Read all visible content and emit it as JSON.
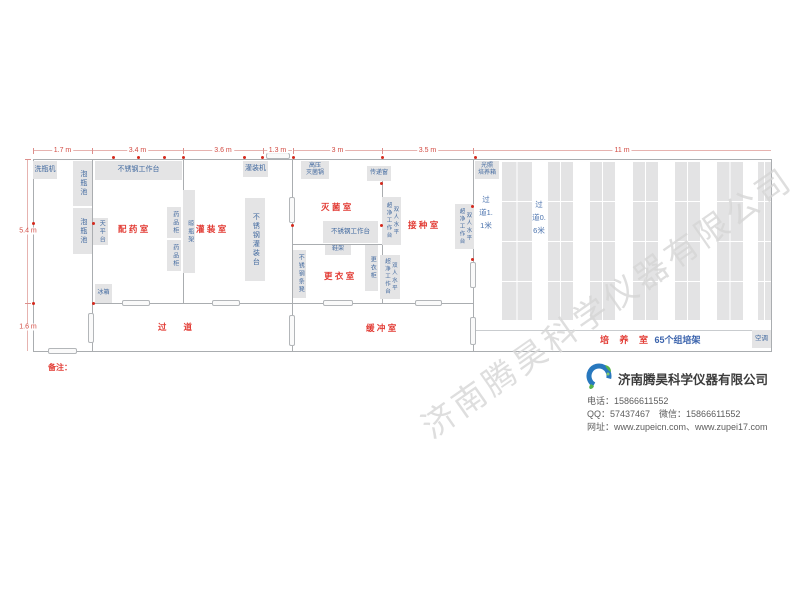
{
  "watermark": "济南腾昊科学仪器有限公司",
  "colors": {
    "equipment_fill": "#e4e4e5",
    "equipment_text_blue": "#41699f",
    "room_label_red": "#e23b34",
    "dimension_red": "#d24a42",
    "wall_gray": "#aaadb0",
    "socket_red": "#d42a1e",
    "logo_blue": "#2878be",
    "logo_green": "#56b44a"
  },
  "plan": {
    "walls": [
      {
        "x": 33,
        "y": 159,
        "w": 739,
        "h": 1
      },
      {
        "x": 33,
        "y": 351,
        "w": 739,
        "h": 1
      },
      {
        "x": 33,
        "y": 159,
        "w": 1,
        "h": 193
      },
      {
        "x": 771,
        "y": 159,
        "w": 1,
        "h": 193
      },
      {
        "x": 92,
        "y": 159,
        "w": 1,
        "h": 145
      },
      {
        "x": 92,
        "y": 303,
        "w": 1,
        "h": 49
      },
      {
        "x": 92,
        "y": 303,
        "w": 381,
        "h": 1
      },
      {
        "x": 183,
        "y": 159,
        "w": 1,
        "h": 145
      },
      {
        "x": 292,
        "y": 159,
        "w": 1,
        "h": 193
      },
      {
        "x": 382,
        "y": 166,
        "w": 1,
        "h": 138
      },
      {
        "x": 293,
        "y": 244,
        "w": 90,
        "h": 1
      },
      {
        "x": 473,
        "y": 159,
        "w": 1,
        "h": 193
      },
      {
        "x": 473,
        "y": 330,
        "w": 298,
        "h": 1,
        "lite": true
      }
    ],
    "equipment": [
      {
        "l": "洗瓶机",
        "x": 33,
        "y": 161,
        "w": 24,
        "h": 18,
        "o": "h",
        "fs": 7
      },
      {
        "l": "泡瓶池",
        "x": 73,
        "y": 161,
        "w": 19,
        "h": 45,
        "o": "v",
        "fs": 7
      },
      {
        "l": "泡瓶池",
        "x": 73,
        "y": 208,
        "w": 19,
        "h": 46,
        "o": "v",
        "fs": 7
      },
      {
        "l": "不锈钢工作台",
        "x": 95,
        "y": 161,
        "w": 87,
        "h": 19,
        "o": "h",
        "fs": 7
      },
      {
        "l": "灌装机",
        "x": 243,
        "y": 161,
        "w": 25,
        "h": 16,
        "o": "h",
        "fs": 7
      },
      {
        "l": "天平台",
        "x": 93,
        "y": 218,
        "w": 15,
        "h": 27,
        "o": "v",
        "fs": 6
      },
      {
        "l": "药品柜",
        "x": 167,
        "y": 207,
        "w": 14,
        "h": 31,
        "o": "v",
        "fs": 6
      },
      {
        "l": "药品柜",
        "x": 167,
        "y": 240,
        "w": 14,
        "h": 31,
        "o": "v",
        "fs": 6
      },
      {
        "l": "晾瓶架",
        "x": 183,
        "y": 190,
        "w": 12,
        "h": 83,
        "o": "v",
        "fs": 6
      },
      {
        "l": "不锈钢灌装台",
        "x": 245,
        "y": 198,
        "w": 20,
        "h": 83,
        "o": "v",
        "fs": 7
      },
      {
        "l": "冰箱",
        "x": 95,
        "y": 284,
        "w": 17,
        "h": 19,
        "o": "h",
        "fs": 6
      },
      {
        "l": "高压|灭菌锅",
        "x": 301,
        "y": 161,
        "w": 28,
        "h": 18,
        "o": "h",
        "fs": 6
      },
      {
        "l": "传递窗",
        "x": 367,
        "y": 166,
        "w": 24,
        "h": 15,
        "o": "h",
        "fs": 6
      },
      {
        "l": "不锈钢工作台",
        "x": 323,
        "y": 221,
        "w": 55,
        "h": 22,
        "o": "h",
        "fs": 6.5
      },
      {
        "l": "鞋架",
        "x": 325,
        "y": 245,
        "w": 26,
        "h": 10,
        "o": "h",
        "fs": 6
      },
      {
        "l": "更衣柜",
        "x": 365,
        "y": 245,
        "w": 13,
        "h": 46,
        "o": "v",
        "fs": 6
      },
      {
        "l": "不锈钢条凳",
        "x": 293,
        "y": 250,
        "w": 13,
        "h": 48,
        "o": "v",
        "fs": 6
      },
      {
        "l": "双人水平|超净工作台",
        "x": 382,
        "y": 197,
        "w": 19,
        "h": 48,
        "o": "v",
        "fs": 5.5
      },
      {
        "l": "双人水平|超净工作台",
        "x": 380,
        "y": 255,
        "w": 20,
        "h": 44,
        "o": "v",
        "fs": 5.5
      },
      {
        "l": "双人水平|超净工作台",
        "x": 455,
        "y": 204,
        "w": 19,
        "h": 45,
        "o": "v",
        "fs": 5.5
      },
      {
        "l": "光照|培养箱",
        "x": 475,
        "y": 161,
        "w": 24,
        "h": 18,
        "o": "h",
        "fs": 6
      },
      {
        "l": "空调",
        "x": 752,
        "y": 330,
        "w": 19,
        "h": 18,
        "o": "h",
        "fs": 6.5
      }
    ],
    "doors": [
      {
        "x": 122,
        "y": 300,
        "w": 28,
        "h": 6
      },
      {
        "x": 212,
        "y": 300,
        "w": 28,
        "h": 6
      },
      {
        "x": 88,
        "y": 313,
        "w": 6,
        "h": 30
      },
      {
        "x": 48,
        "y": 348,
        "w": 29,
        "h": 6
      },
      {
        "x": 289,
        "y": 197,
        "w": 6,
        "h": 26
      },
      {
        "x": 289,
        "y": 315,
        "w": 6,
        "h": 31
      },
      {
        "x": 323,
        "y": 300,
        "w": 30,
        "h": 6
      },
      {
        "x": 415,
        "y": 300,
        "w": 27,
        "h": 6
      },
      {
        "x": 470,
        "y": 262,
        "w": 6,
        "h": 26
      },
      {
        "x": 470,
        "y": 317,
        "w": 6,
        "h": 28
      },
      {
        "x": 266,
        "y": 153,
        "w": 24,
        "h": 6
      }
    ],
    "sockets": [
      {
        "x": 112,
        "y": 156
      },
      {
        "x": 137,
        "y": 156
      },
      {
        "x": 163,
        "y": 156
      },
      {
        "x": 182,
        "y": 156
      },
      {
        "x": 243,
        "y": 156
      },
      {
        "x": 261,
        "y": 156
      },
      {
        "x": 292,
        "y": 156
      },
      {
        "x": 381,
        "y": 156
      },
      {
        "x": 474,
        "y": 156
      },
      {
        "x": 92,
        "y": 222
      },
      {
        "x": 92,
        "y": 302
      },
      {
        "x": 380,
        "y": 182
      },
      {
        "x": 380,
        "y": 224
      },
      {
        "x": 471,
        "y": 205
      },
      {
        "x": 471,
        "y": 258
      },
      {
        "x": 291,
        "y": 224
      },
      {
        "x": 32,
        "y": 222
      },
      {
        "x": 32,
        "y": 302
      }
    ],
    "dims_h": [
      {
        "l": "1.7 m",
        "x1": 33,
        "x2": 92,
        "y": 150
      },
      {
        "l": "3.4 m",
        "x1": 92,
        "x2": 183,
        "y": 150
      },
      {
        "l": "3.6 m",
        "x1": 183,
        "x2": 263,
        "y": 150
      },
      {
        "l": "1.3 m",
        "x1": 263,
        "x2": 292,
        "y": 150
      },
      {
        "l": "3 m",
        "x1": 293,
        "x2": 382,
        "y": 150
      },
      {
        "l": "3.5 m",
        "x1": 382,
        "x2": 473,
        "y": 150
      },
      {
        "l": "11 m",
        "x1": 473,
        "x2": 771,
        "y": 150
      }
    ],
    "dims_v": [
      {
        "l": "5.4 m",
        "y1": 159,
        "y2": 303,
        "x": 27
      },
      {
        "l": "1.6 m",
        "y1": 303,
        "y2": 351,
        "x": 27
      }
    ],
    "racks": [
      {
        "x": 502,
        "w": 30
      },
      {
        "x": 548,
        "w": 25
      },
      {
        "x": 590,
        "w": 25
      },
      {
        "x": 633,
        "w": 25
      },
      {
        "x": 675,
        "w": 25
      },
      {
        "x": 717,
        "w": 26
      },
      {
        "x": 758,
        "w": 13
      }
    ],
    "racks_y": 162,
    "racks_h": 158,
    "aisles": [
      {
        "l": "过道1.1米",
        "x": 479,
        "y": 193
      },
      {
        "l": "过道0.6米",
        "x": 532,
        "y": 198
      }
    ],
    "rooms": [
      {
        "l": "配 药 室",
        "x": 118,
        "y": 223
      },
      {
        "l": "灌 装 室",
        "x": 196,
        "y": 223
      },
      {
        "l": "过　　道",
        "x": 158,
        "y": 321
      },
      {
        "l": "灭 菌 室",
        "x": 321,
        "y": 201
      },
      {
        "l": "更 衣 室",
        "x": 324,
        "y": 270
      },
      {
        "l": "接 种 室",
        "x": 408,
        "y": 219
      },
      {
        "l": "缓 冲 室",
        "x": 366,
        "y": 322
      }
    ],
    "cultivation_label": {
      "room": "培 养 室",
      "count": "65个组培架"
    }
  },
  "notes": {
    "title": "备注：",
    "left": [
      "1、 组培架长 1.25*0.5*1.8m(65 个)",
      "2、 每排组培架靠墙离地 30cm 预留电源插座",
      "3、 空调安装：培养室（3-5 匹）一台，接种室（2 匹）一台。",
      "4、 接种工作台长为 1.5 米",
      "5、 红点代表预留的电源插座"
    ],
    "right": [
      "6、 灭菌锅和洗瓶机离地 1.5 米，预留 380v 电源。",
      "7、 整个组培室预留电源功率 >100kw",
      "8、 培养室推拉门地轨和地面一平，方便小推车推送。",
      "9、 室内所安装的紫外线杀菌灯电源要单独控制。"
    ]
  },
  "company": {
    "name": "济南腾昊科学仪器有限公司",
    "phone": "电话：15866611552",
    "qq": "QQ：57437467　微信：15866611552",
    "web": "网址：www.zupeicn.com、www.zupei17.com",
    "logo_text": "TH"
  }
}
